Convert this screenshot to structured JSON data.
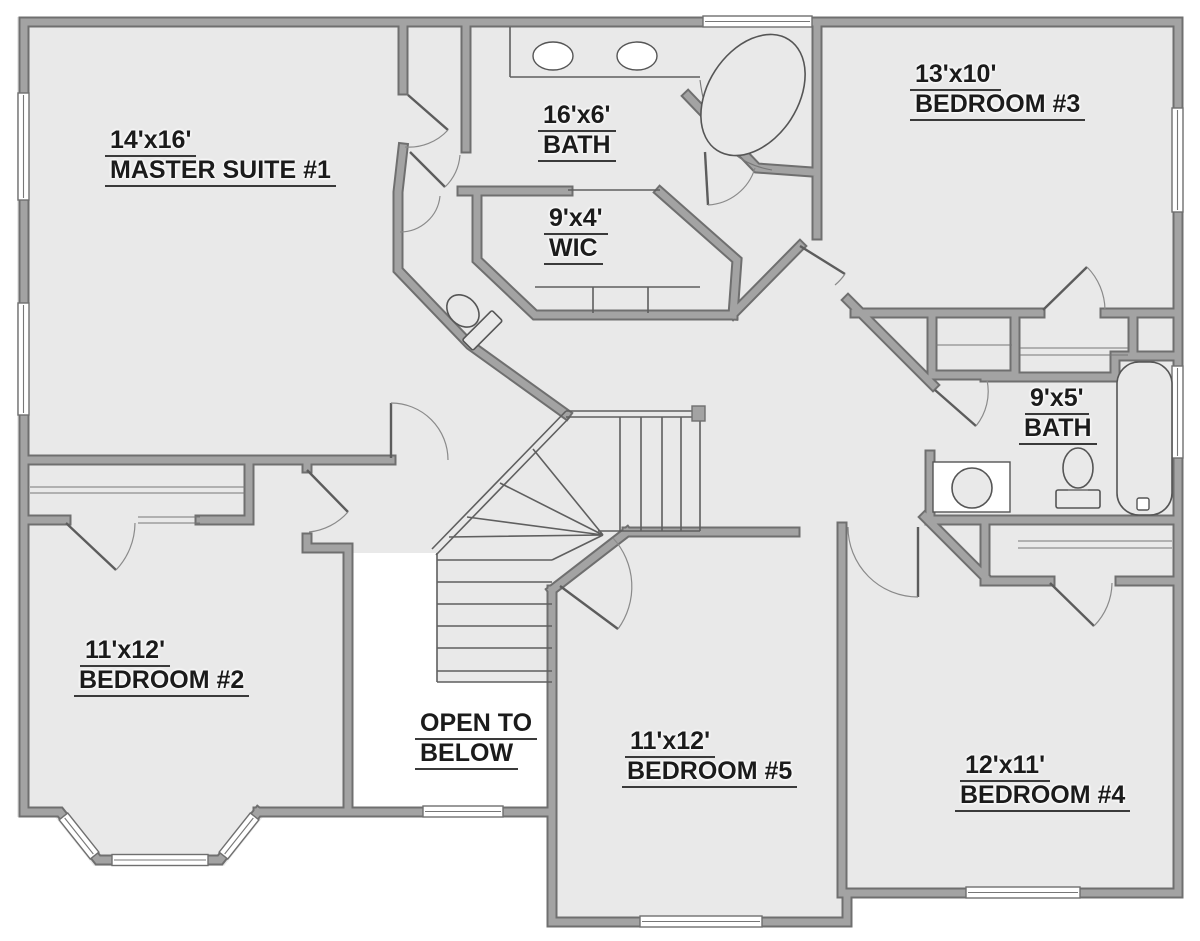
{
  "title": "Second Floor Plan",
  "colors": {
    "background": "#ffffff",
    "floor": "#e9e9e9",
    "wall": "#a3a3a3",
    "wall_edge": "#6f6f6f",
    "line": "#5f5f5f",
    "text": "#1b1b1b"
  },
  "rooms": [
    {
      "id": "master-suite",
      "line1": "14'x16'",
      "line2": "MASTER SUITE #1"
    },
    {
      "id": "master-bath",
      "line1": "16'x6'",
      "line2": "BATH"
    },
    {
      "id": "bedroom-3",
      "line1": "13'x10'",
      "line2": "BEDROOM #3"
    },
    {
      "id": "walk-in-closet",
      "line1": "9'x4'",
      "line2": "WIC"
    },
    {
      "id": "bath-2",
      "line1": "9'x5'",
      "line2": "BATH"
    },
    {
      "id": "bedroom-2",
      "line1": "11'x12'",
      "line2": "BEDROOM #2"
    },
    {
      "id": "open-to-below",
      "line1": "OPEN TO",
      "line2": "BELOW"
    },
    {
      "id": "bedroom-5",
      "line1": "11'x12'",
      "line2": "BEDROOM #5"
    },
    {
      "id": "bedroom-4",
      "line1": "12'x11'",
      "line2": "BEDROOM #4"
    }
  ],
  "fixtures": [
    "double-vanity-sinks",
    "garden-tub",
    "water-closet-toilet",
    "closet-shelves",
    "bathtub",
    "toilet",
    "laundry-fixture",
    "staircase",
    "stair-railing",
    "windows",
    "door-swings",
    "bay-window"
  ]
}
